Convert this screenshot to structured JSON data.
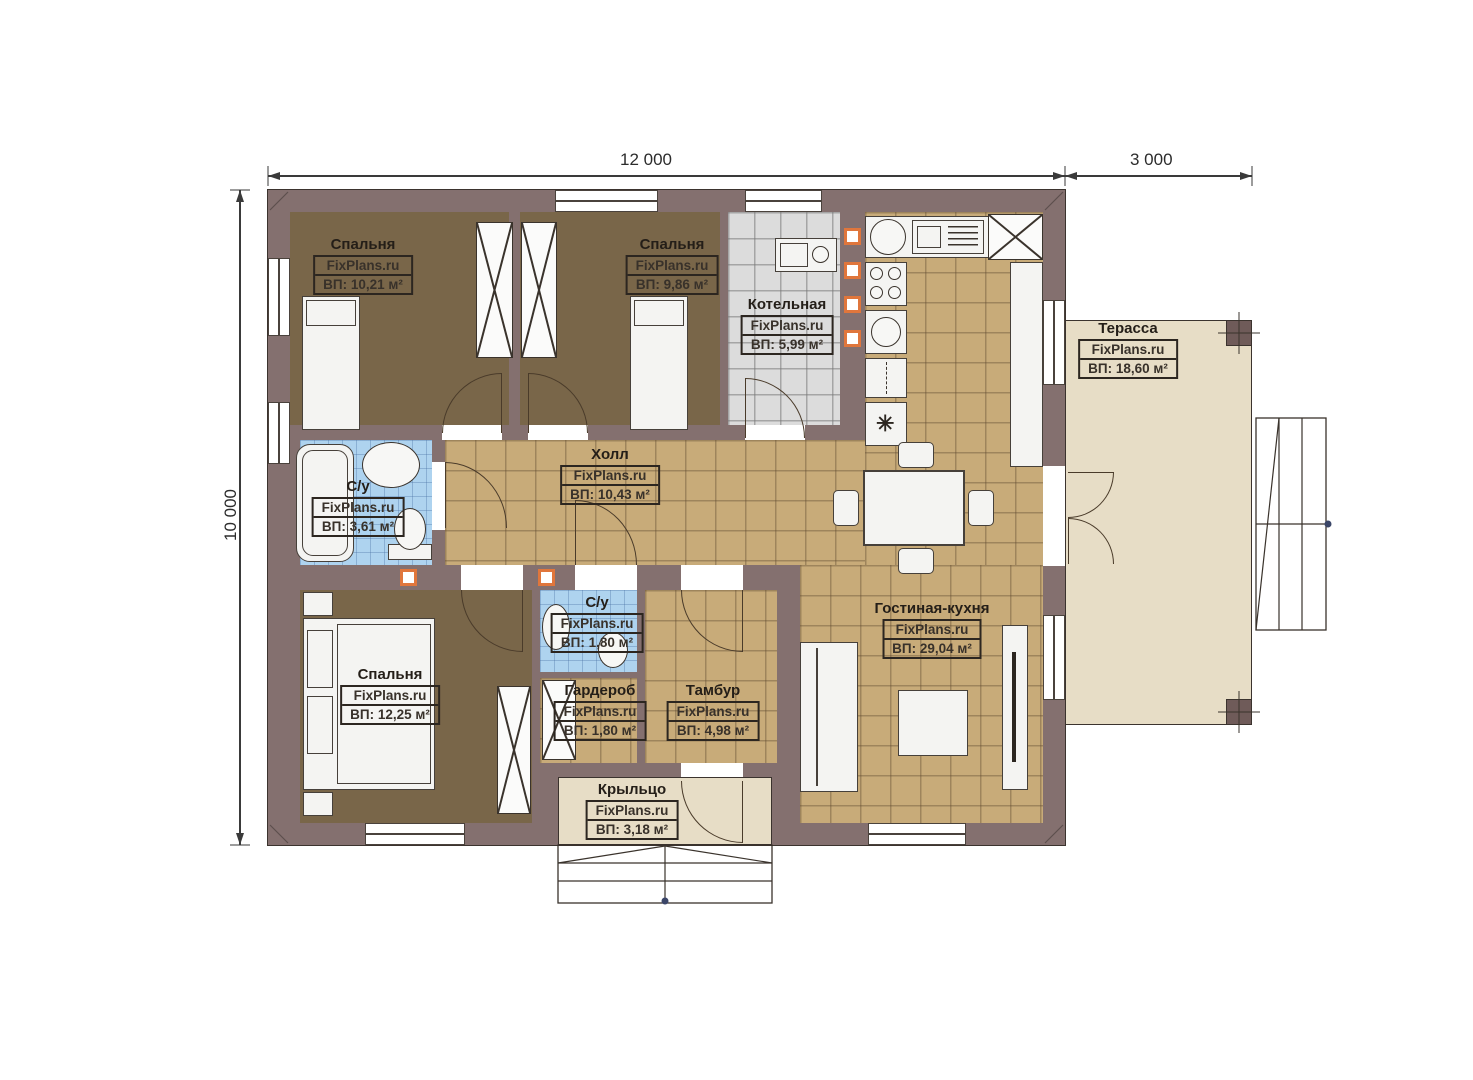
{
  "watermark": "FixPlans.ru",
  "dimensions": {
    "width_main": "12 000",
    "width_terrace": "3 000",
    "height": "10 000"
  },
  "rooms": [
    {
      "id": "bedroom-1",
      "name": "Спальня",
      "area": "ВП: 10,21 м²"
    },
    {
      "id": "bedroom-2",
      "name": "Спальня",
      "area": "ВП: 9,86 м²"
    },
    {
      "id": "boiler",
      "name": "Котельная",
      "area": "ВП: 5,99 м²"
    },
    {
      "id": "terrace",
      "name": "Терасса",
      "area": "ВП: 18,60 м²"
    },
    {
      "id": "hall",
      "name": "Холл",
      "area": "ВП: 10,43 м²"
    },
    {
      "id": "bathroom-1",
      "name": "С/у",
      "area": "ВП: 3,61 м²"
    },
    {
      "id": "bedroom-3",
      "name": "Спальня",
      "area": "ВП: 12,25 м²"
    },
    {
      "id": "bathroom-2",
      "name": "С/у",
      "area": "ВП: 1,80 м²"
    },
    {
      "id": "wardrobe",
      "name": "Гардероб",
      "area": "ВП: 1,80 м²"
    },
    {
      "id": "tambour",
      "name": "Тамбур",
      "area": "ВП: 4,98 м²"
    },
    {
      "id": "living-kitchen",
      "name": "Гостиная-кухня",
      "area": "ВП: 29,04 м²"
    },
    {
      "id": "porch",
      "name": "Крыльцо",
      "area": "ВП: 3,18 м²"
    }
  ],
  "icons": {
    "snowflake": "✳"
  },
  "colors": {
    "wall": "#84706f",
    "bedroom_floor": "#796649",
    "tile_tan": "#c8ab79",
    "tile_gray": "#dcdcdc",
    "tile_blue": "#aed3ef",
    "terrace_floor": "#e7ddc6",
    "vent_orange": "#e0763c"
  }
}
